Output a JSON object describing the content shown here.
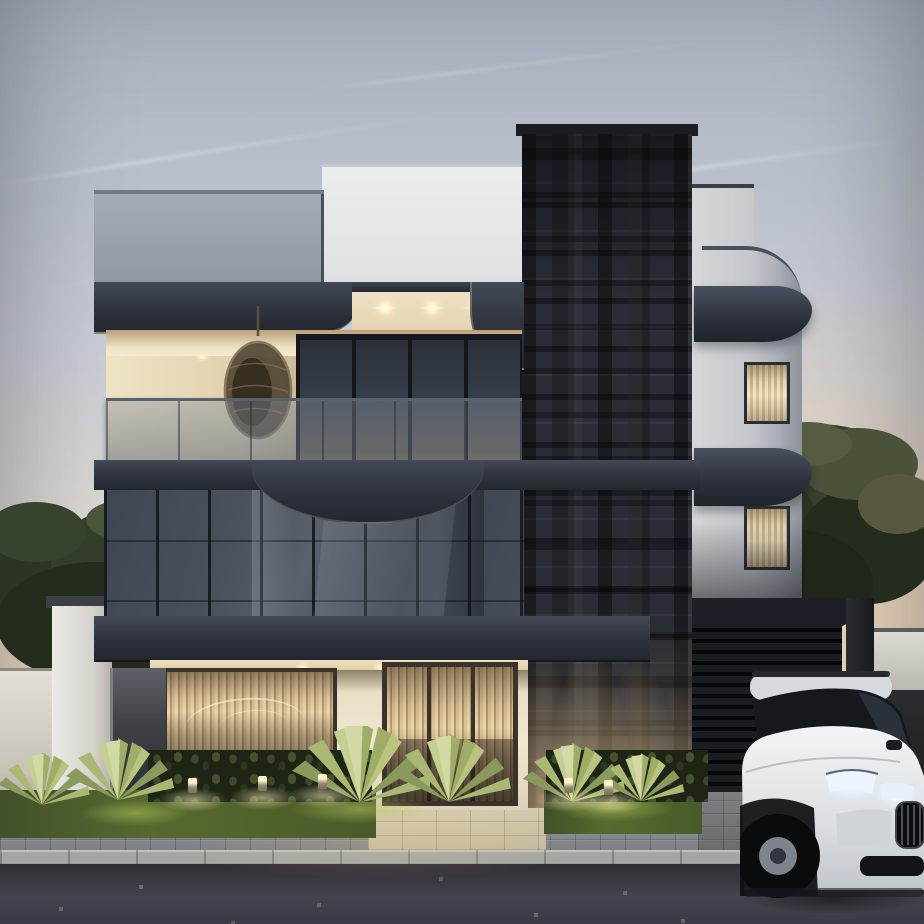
{
  "scene": {
    "type": "architectural exterior rendering",
    "time_of_day": "dusk",
    "floors_visible": 3
  },
  "labels": {
    "scene": "Modern three-story house at dusk with white SUV parked in front",
    "sky": "dusk sky with faint contrails",
    "trees_left": "trees behind left boundary wall",
    "tree_right": "tree behind garage",
    "left_wing": "left wing with gray parapet and terrace",
    "center_tower": "dark textured brick feature tower",
    "right_wing": "white rounded wing with wrapped dark bands",
    "terrace": "top floor terrace with glass railing and hanging egg chair",
    "glass_facade": "second floor dark reflective glass curtain wall",
    "ground_floor": "warm lit ground floor with blinds windows",
    "entry_door": "glass entry door with vertical blinds",
    "garage": "dark slatted garage door with canopy frame",
    "garden": "grass, hedges, agave plants, bollard lights",
    "hardscape": "paver sidewalk, stone walkway, curb and asphalt road",
    "car": "white SUV with lit headlights and dark kidney grille"
  },
  "counts": {
    "soffit_star_lights": 3,
    "terrace_ceiling_downlights": 2,
    "ground_soffit_downlights": 3,
    "brick_uplight_cones": 4,
    "garden_bollard_lights": 5,
    "right_wing_curtain_windows": 2
  },
  "palette": {
    "sky_top": "#a9b1c0",
    "sky_mid": "#c9cdd5",
    "sky_low": "#e0dcd5",
    "sky_warm": "#ecd9c0",
    "parapet_gray": "#9aa0a9",
    "parapet_white": "#e8e8ea",
    "wing_white": "#cfd1d6",
    "charcoal": "#343a46",
    "charcoal_dark": "#23272f",
    "brick": "#2a2d35",
    "ceiling_warm": "#f2e6ca",
    "glow_warm": "#fff6dc",
    "glass": "#454b57",
    "mullion": "#1e2228",
    "cream": "#efe5cf",
    "blinds_tan": "#c7a87c",
    "garage_black": "#16181c",
    "tree_green": "#36402c",
    "grass_green": "#54652e",
    "agave_green": "#aab873",
    "paver_gray": "#85878b",
    "walkway_tan": "#d3c9af",
    "curb_gray": "#a2a3a0",
    "asphalt": "#3b3840",
    "car_white": "#e7e9eb",
    "headlight": "#f5f9ff"
  }
}
